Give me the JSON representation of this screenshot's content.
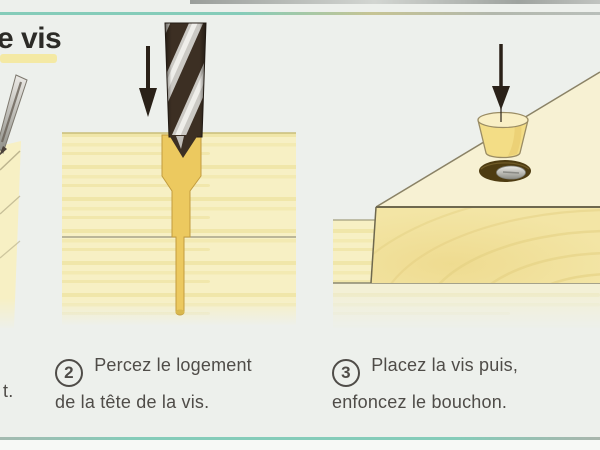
{
  "page": {
    "title_fragment": "e vis"
  },
  "panels": [
    {
      "name": "step-1",
      "caption_fragment": "t.",
      "illustration": "drill-into-wood-partial"
    },
    {
      "name": "step-2",
      "number": "2",
      "caption_line1": "Percez le logement",
      "caption_line2": "de la tête de la vis.",
      "illustration": "drill-counterbore-cross-section"
    },
    {
      "name": "step-3",
      "number": "3",
      "caption_line1": "Placez la vis puis,",
      "caption_line2": "enfoncez le bouchon.",
      "illustration": "wood-plug-above-screw-hole"
    }
  ],
  "colors": {
    "background": "#edf0ec",
    "teal": "#85ccb9",
    "text_dark": "#2c2b27",
    "caption_gray": "#4f4c48",
    "highlight_yellow": "#f4e9a4",
    "wood_light": "#f7f0c4",
    "wood_streak": "#eadc8e",
    "wood_edge": "#c9bd7a",
    "hole_gold": "#ecc95f",
    "hole_gold_outline": "#c29c3f",
    "drill_dark": "#3c2f23",
    "drill_silver": "#cbc9c4",
    "arrow_dark": "#2a2118",
    "block_front": "#f3e5a5",
    "block_top": "#f7f1d3",
    "grain_line": "#e2cd7e",
    "plug_fill": "#f3dd86",
    "plug_top": "#f9efc5",
    "plug_outline": "#9a8c64",
    "hole_brown": "#4e3c12",
    "screw_silver": "#c8c8c2"
  }
}
